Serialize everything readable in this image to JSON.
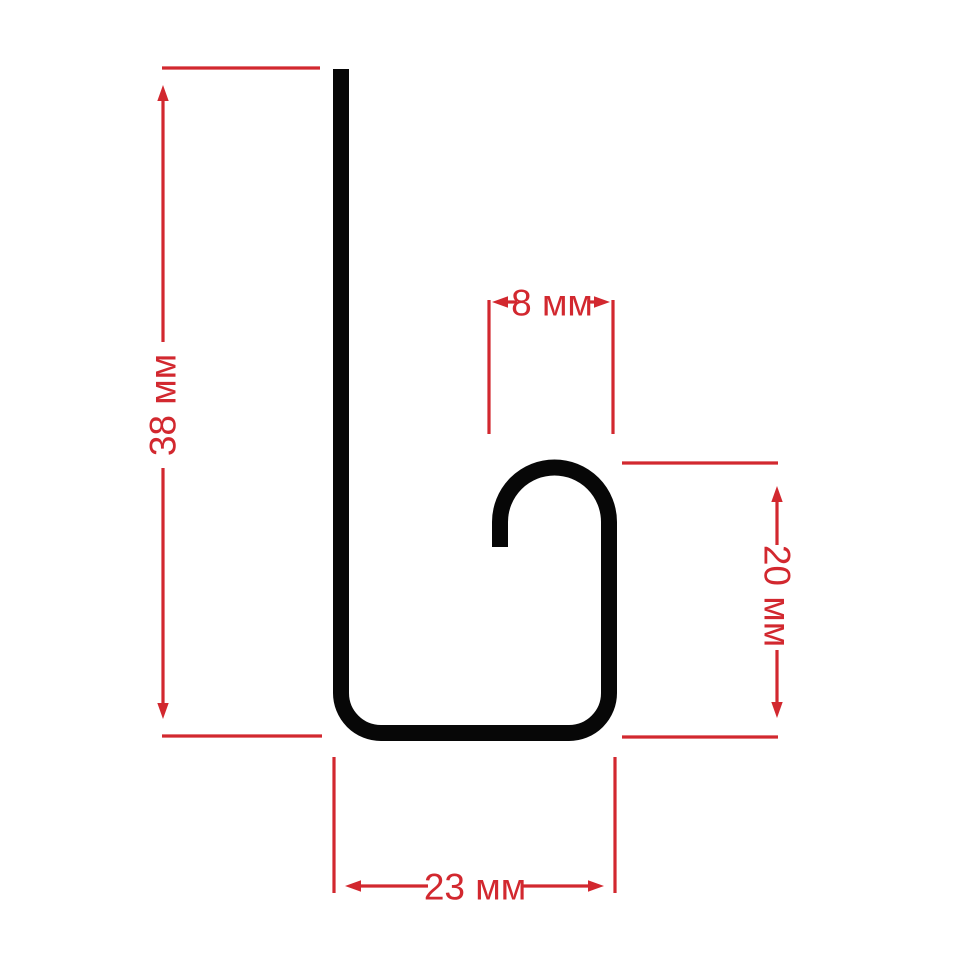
{
  "diagram": {
    "unit": "мм",
    "colors": {
      "background": "#ffffff",
      "profile": "#070707",
      "dimension": "#d2282f"
    },
    "dimensions": {
      "height": {
        "label": "38 мм",
        "value": 38
      },
      "hook_width": {
        "label": "8 мм",
        "value": 8
      },
      "hook_depth": {
        "label": "20 мм",
        "value": 20
      },
      "base_width": {
        "label": "23 мм",
        "value": 23
      }
    }
  }
}
